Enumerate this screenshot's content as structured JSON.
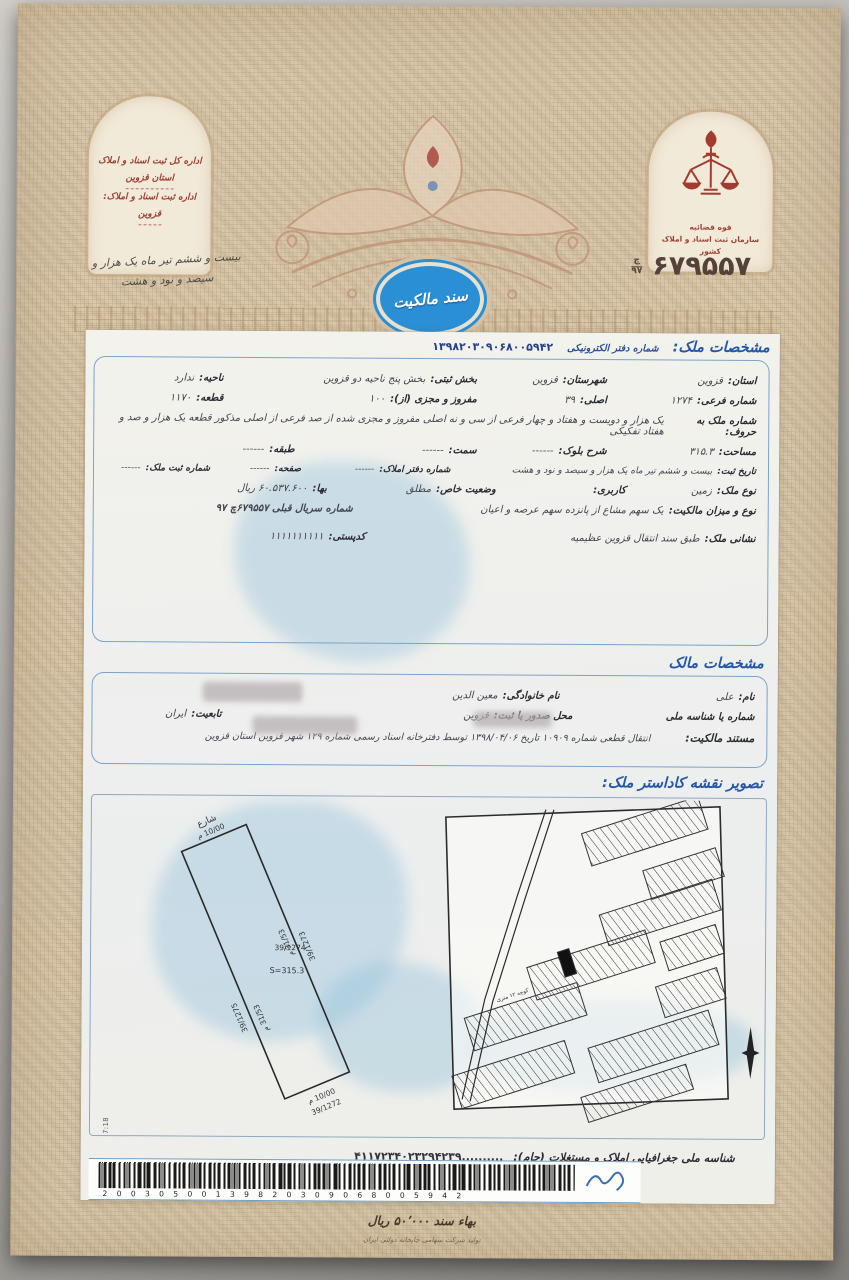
{
  "doc": {
    "serial": {
      "prefix_top": "چ",
      "prefix_bottom": "۹۷",
      "number": "۶۷۹۵۵۷"
    },
    "left_arch": {
      "line1": "اداره کل ثبت اسناد و املاک",
      "line2": "استان قزوین",
      "line3": "اداره ثبت اسناد و املاک:",
      "line4": "قزوین"
    },
    "handwritten_date": {
      "line1": "بیست و ششم تیر ماه یک هزار و",
      "line2": "سیصد و نود و هشت"
    },
    "badge_title": "سند مالکیت",
    "emblem": {
      "caption1": "قوه قضائیه",
      "caption2": "سازمان ثبت اسناد و املاک کشور"
    }
  },
  "property_section": {
    "title": "مشخصات ملک:",
    "eoffice_label": "شماره دفتر الکترونیکی",
    "eoffice_value": "۱۳۹۸۲۰۳۰۹۰۶۸۰۰۵۹۴۲",
    "ostan_label": "استان:",
    "ostan": "قزوین",
    "shahrestan_label": "شهرستان:",
    "shahrestan": "قزوین",
    "bakhsh_label": "بخش ثبتی:",
    "bakhsh": "بخش پنج ناحیه دو قزوین",
    "nahiye_label": "ناحیه:",
    "nahiye": "ندارد",
    "farei_label": "شماره فرعی:",
    "farei": "۱۲۷۴",
    "asli_label": "اصلی:",
    "asli": "۳۹",
    "mafruz_label": "مفروز و مجزی (از):",
    "mafruz": "۱۰۰",
    "qete_label": "قطعه:",
    "qete": "۱۱۷۰",
    "horuf_label": "شماره ملک به حروف:",
    "horuf": "یک هزار و دویست و هفتاد و چهار فرعی از سی و نه اصلی مفروز و مجزی شده از صد فرعی از اصلی مذکور قطعه یک هزار و صد و هفتاد تفکیکی",
    "masahat_label": "مساحت:",
    "masahat": "۳۱۵.۳",
    "bolok_label": "شرح بلوک:",
    "bolok": "------",
    "samt_label": "سمت:",
    "samt": "------",
    "tabaqe_label": "طبقه:",
    "tabaqe": "------",
    "tarikh_label": "تاریخ ثبت:",
    "tarikh": "بیست و ششم تیر ماه یک هزار و سیصد و نود و هشت",
    "daftar_label": "شماره دفتر املاک:",
    "daftar": "------",
    "safhe_label": "صفحه:",
    "safhe": "------",
    "sabt_label": "شماره ثبت ملک:",
    "sabt": "------",
    "noe_label": "نوع ملک:",
    "noe": "زمین",
    "karbari_label": "کاربری:",
    "karbari": "",
    "vaziat_label": "وضعیت خاص:",
    "vaziat": "مطلق",
    "baha_label": "بها:",
    "baha": "۶۰.۵۳۷.۶۰۰ ریال",
    "mizan_label": "نوع و میزان مالکیت:",
    "mizan": "یک سهم مشاع از پانزده سهم عرصه و اعیان",
    "serial_qabli": "شماره سریال قبلی ۶۷۹۵۵۷چ ۹۷",
    "neshani_label": "نشانی ملک:",
    "neshani": "طبق سند انتقال قزوین عظیمیه",
    "codpost_label": "کدپستی:",
    "codpost": "۱۱۱۱۱۱۱۱۱۱"
  },
  "owner_section": {
    "title": "مشخصات مالک",
    "name_label": "نام:",
    "name": "علی",
    "family_label": "نام خانوادگی:",
    "family": "معین الدین",
    "id_label": "شماره یا شناسه ملی",
    "place_label": "محل صدور یا ثبت:",
    "place": "قزوین",
    "nation_label": "تابعیت:",
    "nation": "ایران",
    "mostanad_label": "مستند مالکیت:",
    "mostanad": "انتقال قطعی شماره ۱۰۹۰۹ تاریخ ۱۳۹۸/۰۴/۰۶ توسط دفترخانه اسناد رسمی شماره ۱۲۹ شهر قزوین استان قزوین"
  },
  "cadastre_section": {
    "title": "تصویر نقشه کاداستر ملک:",
    "street": "شارع",
    "len_top": "10/00 م",
    "len_side_left": "31/53 م",
    "len_side_right": "31/53 م",
    "len_bottom": "10/00 م",
    "parcel_left": "39/1275",
    "parcel_self": "39/1274",
    "area": "S=315.3",
    "parcel_right": "39/1273",
    "parcel_bottom": "39/1272",
    "meta": "12:47:18_1396/05/08_4023294.55_411723.20_171353__29",
    "street_label": "کوچه ۱۲ متری"
  },
  "footer": {
    "jam_label": "شناسه ملی جغرافیایی املاک و مستغلات (جام):",
    "jam_value": "۴۱۱۷۲۳۴۰۲۳۲۹۴۲۳۹..........",
    "barcode_digits": "2 0 0 3 0 5 0 0 1 3 9 8 2 0 3 0 9 0 6 8 0 0 5 9 4 2",
    "price": "بهاء سند ۵۰٬۰۰۰ ریال",
    "printer": "تولید شرکت سهامی چاپخانه دولتی ایران"
  },
  "colors": {
    "accent_blue": "#2457a8",
    "stamp_blue": "#2a8fd4",
    "maroon": "#9c4034",
    "paper": "#d8c7aa"
  }
}
